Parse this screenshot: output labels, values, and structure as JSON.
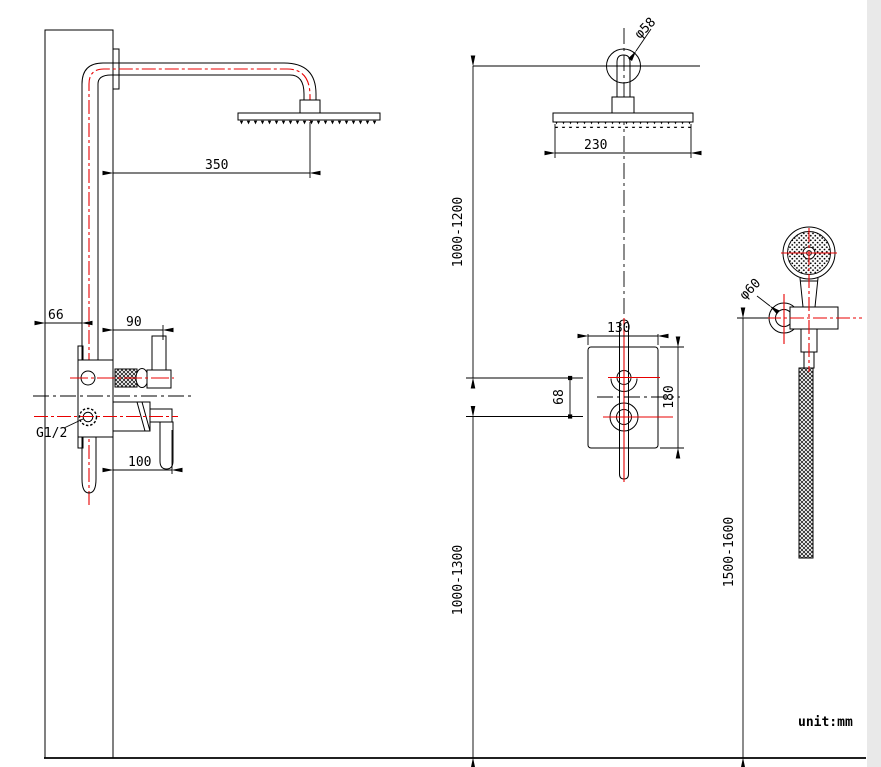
{
  "drawing": {
    "title": "shower-system-installation-drawing",
    "unit_label": "unit:mm",
    "colors": {
      "line": "#000000",
      "centerline_red": "#e80000",
      "background": "#ffffff"
    }
  },
  "left_view": {
    "arm_length": "350",
    "wall_to_pipe": "66",
    "diverter_projection": "90",
    "handle_projection": "100",
    "thread_label": "G1/2"
  },
  "front_view": {
    "flange_diameter": "φ58",
    "head_width": "230",
    "head_height_range": "1000-1200",
    "valve_height_range": "1000-1300",
    "valve_width": "130",
    "handle_spacing": "68",
    "valve_height": "180"
  },
  "hand_shower": {
    "holder_diameter": "φ60",
    "holder_height_range": "1500-1600"
  }
}
